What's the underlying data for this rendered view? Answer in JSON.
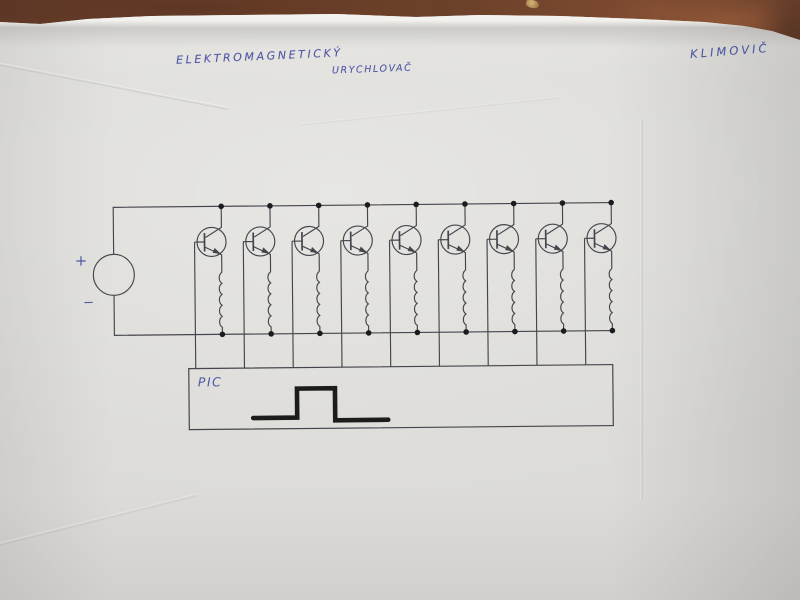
{
  "photo": {
    "table_color": "#71432d",
    "paper_color": "#dcdbd7"
  },
  "handwriting": {
    "ink_color": "#5059a6",
    "title_line1": "ELEKTROMAGNETICKÝ",
    "title_line2": "URYCHLOVAČ",
    "author": "KLIMOVIČ"
  },
  "circuit": {
    "line_color": "#45454d",
    "dot_color": "#1b1b20",
    "pulse_color": "#1c1c1c",
    "source_plus": "+",
    "source_minus": "−",
    "stage_count": 9,
    "controller_label": "PIC"
  }
}
